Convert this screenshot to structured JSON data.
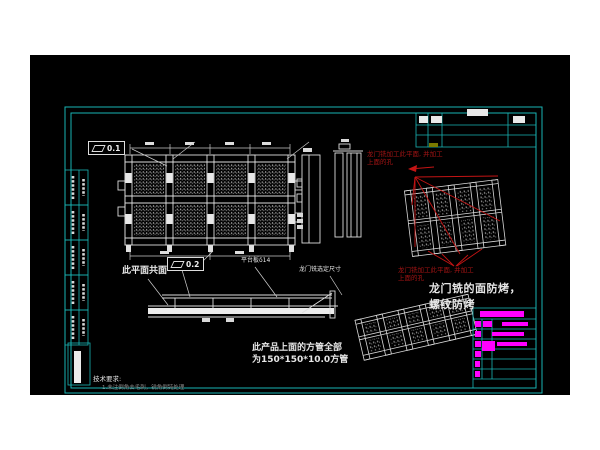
{
  "page": {
    "background": "#ffffff",
    "canvas_background": "#000000",
    "frame_color": "#19b5b5",
    "line_color": "#dcdcdc",
    "red_annotation_color": "#a31414",
    "magenta_color": "#ff00ff"
  },
  "annotations": {
    "red_note_top": {
      "line1": "龙门铣加工此平面, 并加工",
      "line2": "上面的孔"
    },
    "red_note_mid": {
      "line1": "龙门铣加工此平面, 并加工",
      "line2": "上面的孔"
    },
    "bake_note": {
      "line1": "龙门铣的面防烤，",
      "line2": "螺纹防烤"
    },
    "tube_note": {
      "line1": "此产品上面的方管全部",
      "line2": "为150*150*10.0方管"
    },
    "coplanar_note": "此平面共面",
    "platform_label": "平台板δ14",
    "gantry_dim_label": "龙门铣选定尺寸",
    "tech_requirements": {
      "title": "技术要求:",
      "item1": "1.未注倒角去毛刺，锐角倒钝处理"
    }
  },
  "tolerances": {
    "flatness_top": "0.1",
    "flatness_mid": "0.2"
  },
  "icons": {
    "flatness_symbol": "parallelogram"
  }
}
